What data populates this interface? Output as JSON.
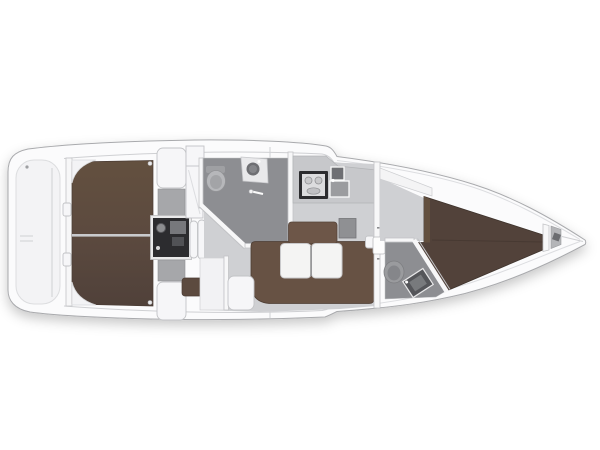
{
  "diagram": {
    "type": "yacht-floor-plan",
    "description": "Top-down interior layout plan of a sailing yacht, bow pointing right",
    "regions": [
      {
        "id": "swim-platform",
        "label": "Swim platform / bathing steps"
      },
      {
        "id": "cockpit",
        "label": "Cockpit with teak floor"
      },
      {
        "id": "engine",
        "label": "Engine compartment"
      },
      {
        "id": "companionway",
        "label": "Companionway steps"
      },
      {
        "id": "aft-head",
        "label": "Aft bathroom with WC, basin and shower"
      },
      {
        "id": "galley",
        "label": "Galley with stove and double sink"
      },
      {
        "id": "saloon",
        "label": "Saloon with U-shaped settee and folding table"
      },
      {
        "id": "chart-table",
        "label": "Chart table"
      },
      {
        "id": "fwd-head",
        "label": "Forward bathroom with WC and basin"
      },
      {
        "id": "fwd-cabin",
        "label": "Forward cabin with V-berth"
      },
      {
        "id": "anchor",
        "label": "Anchor locker"
      },
      {
        "id": "hull",
        "label": "Hull outline"
      },
      {
        "id": "cockpit-seat",
        "label": "Cockpit seat"
      },
      {
        "id": "wardrobe",
        "label": "Wardrobe"
      },
      {
        "id": "bench",
        "label": "Side bench seat"
      }
    ]
  },
  "colors": {
    "hull": "#fbfbfc",
    "hullStroke": "#a9aaad",
    "deck": "#f3f3f5",
    "deckLine": "#cfd0d3",
    "wall": "#f7f7f8",
    "wallStroke": "#c2c3c6",
    "white": "#f6f6f8",
    "floor": "#cfd0d3",
    "floorDark": "#8d8e92",
    "teak": "#5c4a3f",
    "teakDark": "#4b3d35",
    "upholstery": "#675244",
    "cushion": "#6d5648",
    "bedFwd": "#52423a",
    "table": "#f4f4f3",
    "engine": "#2c2c2f",
    "counter": "#c7c8cb",
    "fixture": "#9b9c9f",
    "fixtureDark": "#6e6f73",
    "graySeat": "#a6a7aa",
    "pocket": "#b4b5b8"
  }
}
